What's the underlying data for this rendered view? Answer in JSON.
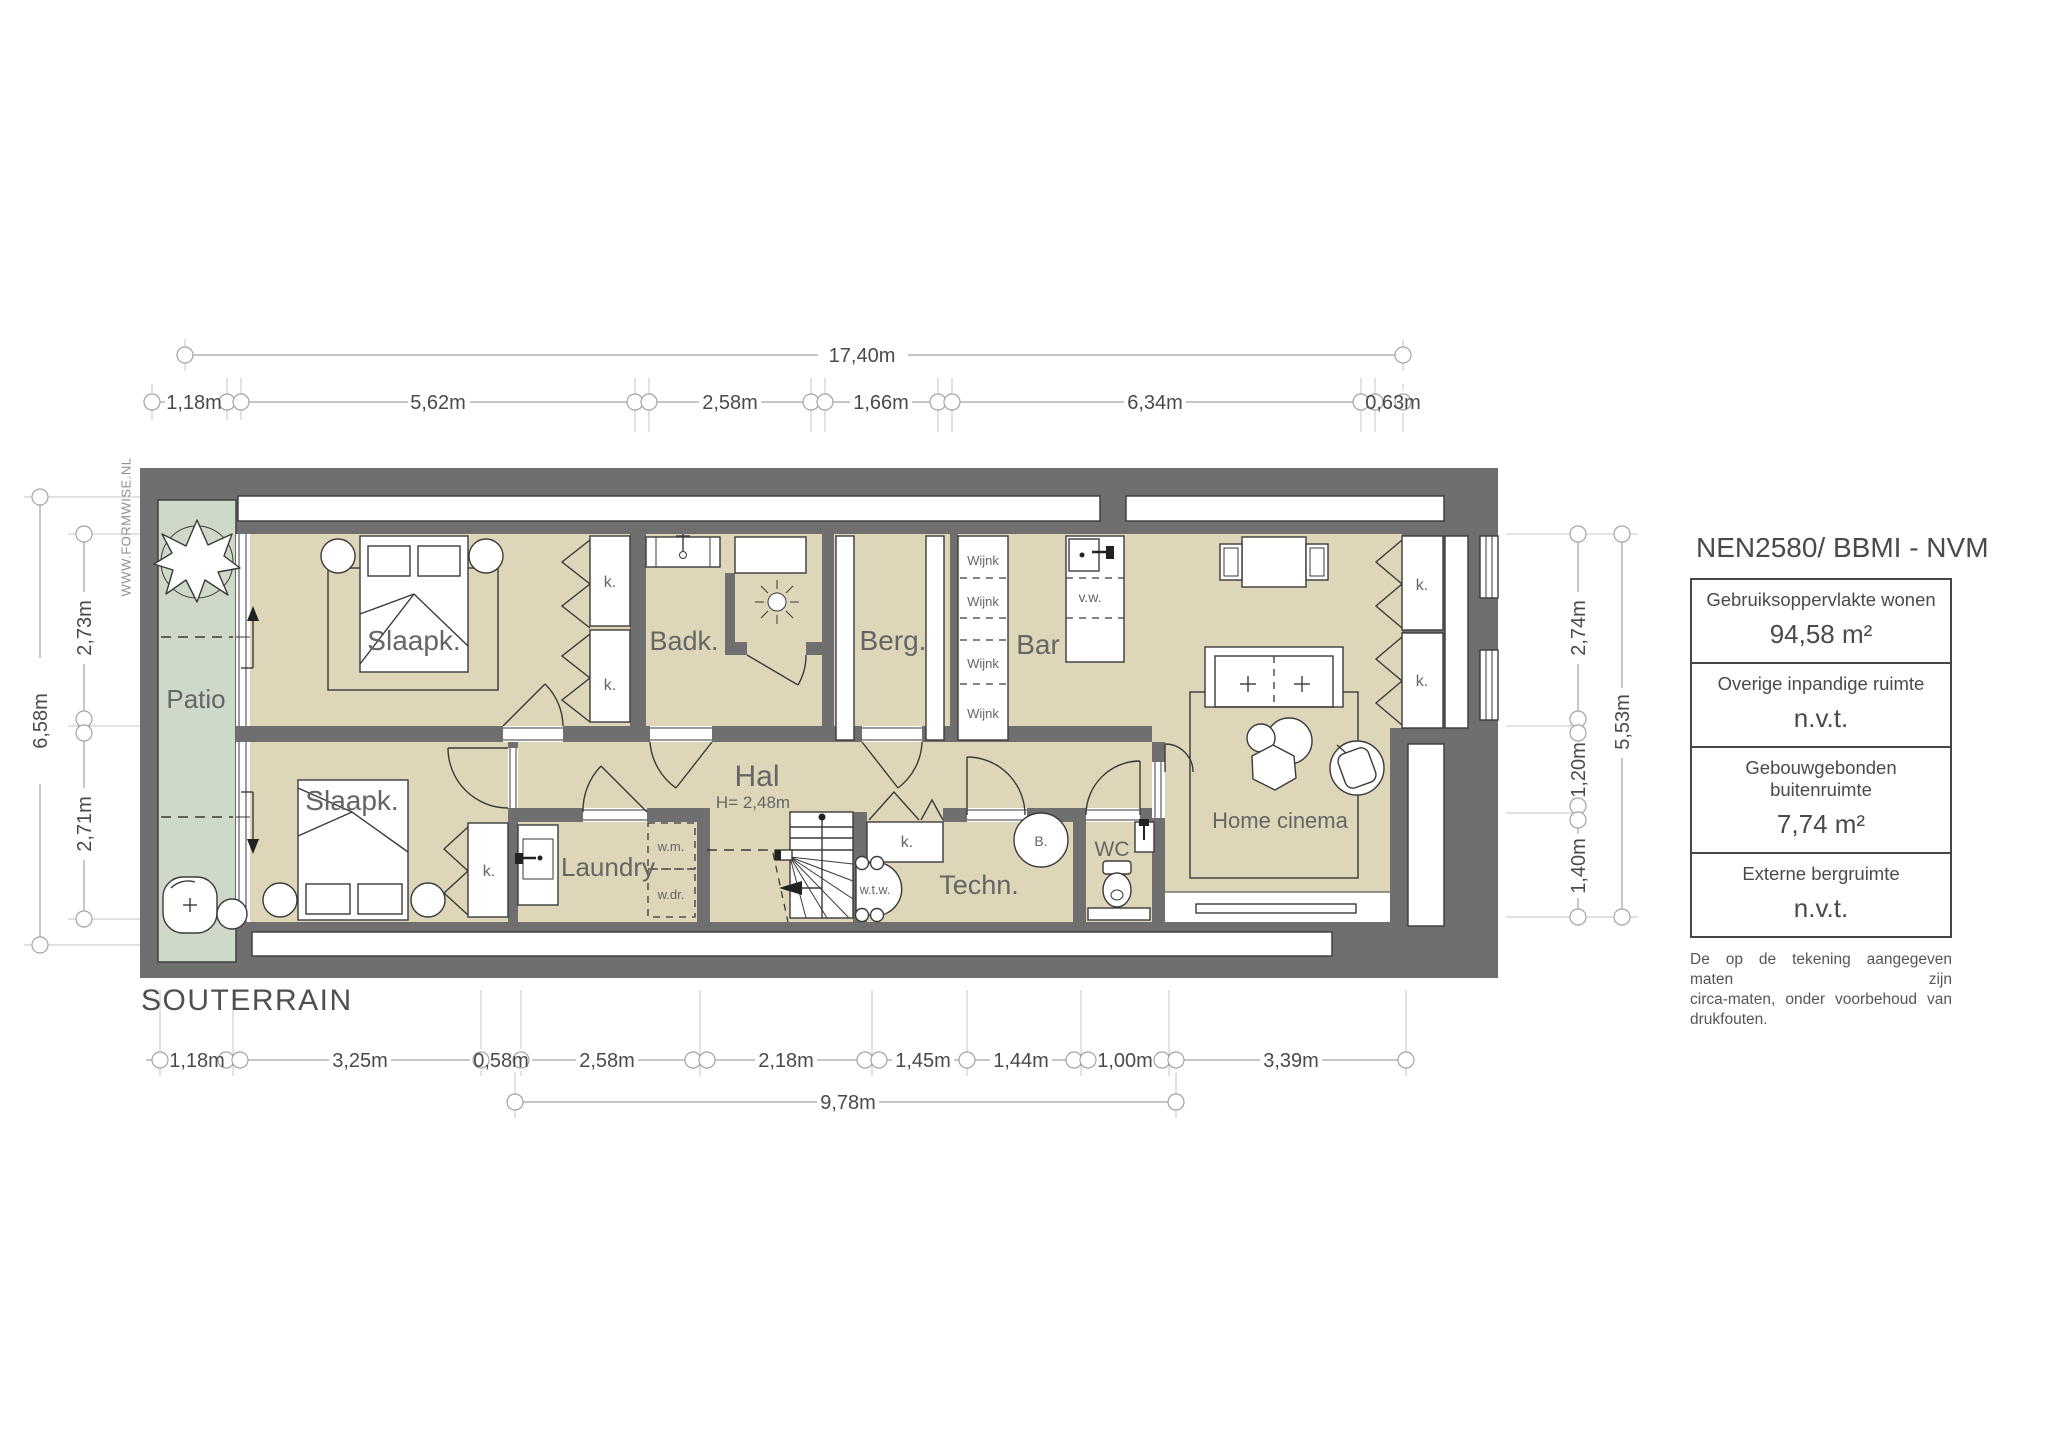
{
  "title": {
    "floor_label": "SOUTERRAIN",
    "watermark": "WWW.FORMWISE.NL"
  },
  "dimensions": {
    "top": {
      "total": "17,40m",
      "segments": [
        "1,18m",
        "5,62m",
        "2,58m",
        "1,66m",
        "6,34m",
        "0,63m"
      ]
    },
    "bottom": {
      "segments": [
        "1,18m",
        "3,25m",
        "0,58m",
        "2,58m",
        "2,18m",
        "1,45m",
        "1,44m",
        "1,00m",
        "3,39m"
      ],
      "total": "9,78m"
    },
    "left": {
      "total": "6,58m",
      "segments": [
        "2,73m",
        "2,71m"
      ]
    },
    "right": {
      "segments": [
        "2,74m",
        "1,20m",
        "1,40m"
      ],
      "total": "5,53m"
    }
  },
  "rooms": {
    "patio": "Patio",
    "bedroom1": "Slaapk.",
    "bathroom": "Badk.",
    "storage": "Berg.",
    "bar": "Bar",
    "hall": "Hal",
    "hall_height": "H= 2,48m",
    "bedroom2": "Slaapk.",
    "laundry": "Laundry",
    "technical": "Techn.",
    "wc": "WC",
    "home_cinema": "Home cinema"
  },
  "fixtures": {
    "closet": "k.",
    "wine_rack": "Wijnk",
    "washing_machine": "w.m.",
    "dryer": "w.dr.",
    "heat_recovery": "w.t.w.",
    "sink_cabinet": "v.w.",
    "boiler": "B."
  },
  "legend": {
    "title": "NEN2580/ BBMI - NVM",
    "rows": [
      {
        "label": "Gebruiksoppervlakte wonen",
        "value": "94,58 m²"
      },
      {
        "label": "Overige inpandige ruimte",
        "value": "n.v.t."
      },
      {
        "label": "Gebouwgebonden buitenruimte",
        "value": "7,74 m²"
      },
      {
        "label": "Externe bergruimte",
        "value": "n.v.t."
      }
    ],
    "disclaimer_line1": "De op de tekening aangegeven maten zijn",
    "disclaimer_line2": "circa-maten, onder voorbehoud van drukfouten."
  },
  "colors": {
    "wall": "#6f6f6f",
    "floor": "#ddd6b8",
    "patio": "#cfd9ca",
    "dimension": "#a3a3a3",
    "label": "#656565"
  }
}
